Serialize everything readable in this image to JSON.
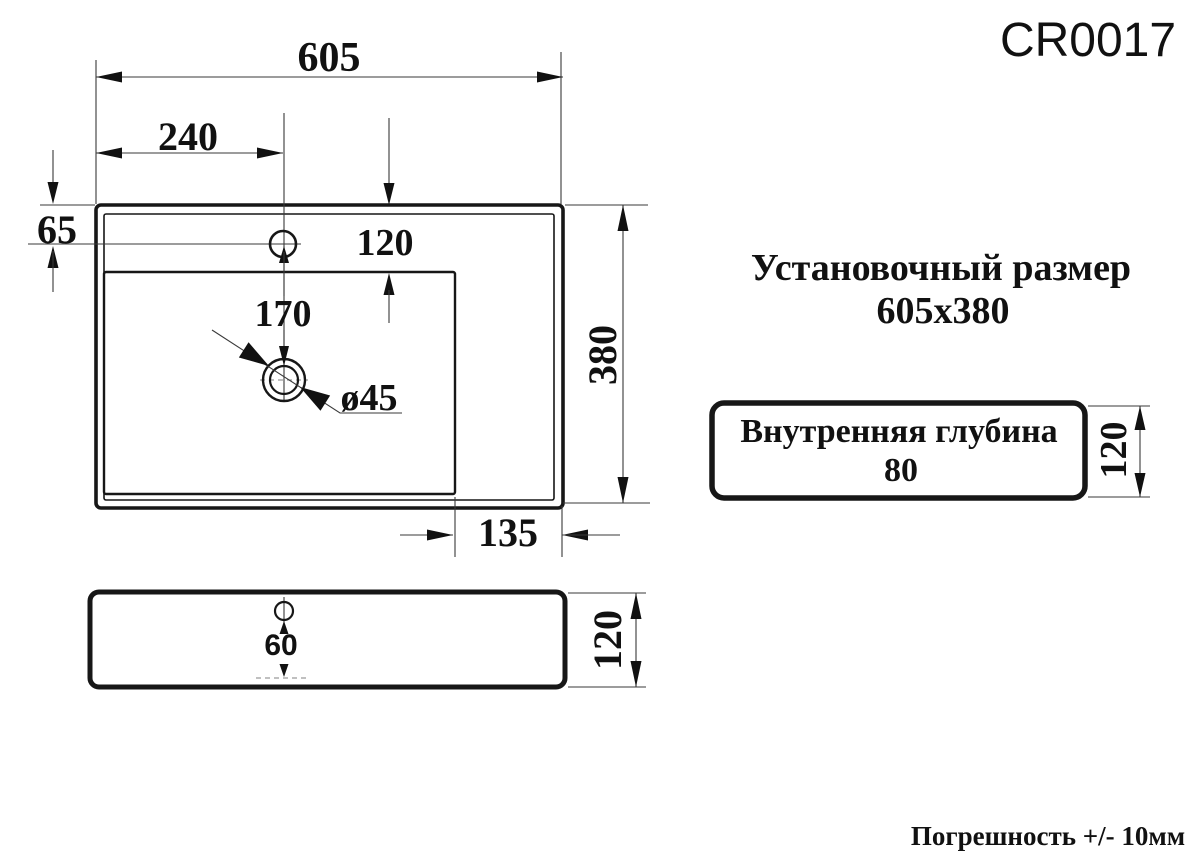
{
  "title": {
    "model": "CR0017"
  },
  "installation": {
    "line1": "Установочный размер",
    "line2": "605x380"
  },
  "depth_box": {
    "line1": "Внутренняя глубина",
    "line2": "80",
    "height_dim": "120"
  },
  "tolerance_note": "Погрешность +/- 10мм",
  "top_view": {
    "total_width": "605",
    "hole_offset_left": "240",
    "hole_offset_top": "65",
    "deck_to_basin": "120",
    "hole_to_drain": "170",
    "drain_diameter": "ø45",
    "total_depth": "380",
    "side_shelf": "135"
  },
  "side_view": {
    "hole_drop": "60",
    "body_height": "120"
  },
  "colors": {
    "line": "#171717",
    "background": "#ffffff"
  }
}
